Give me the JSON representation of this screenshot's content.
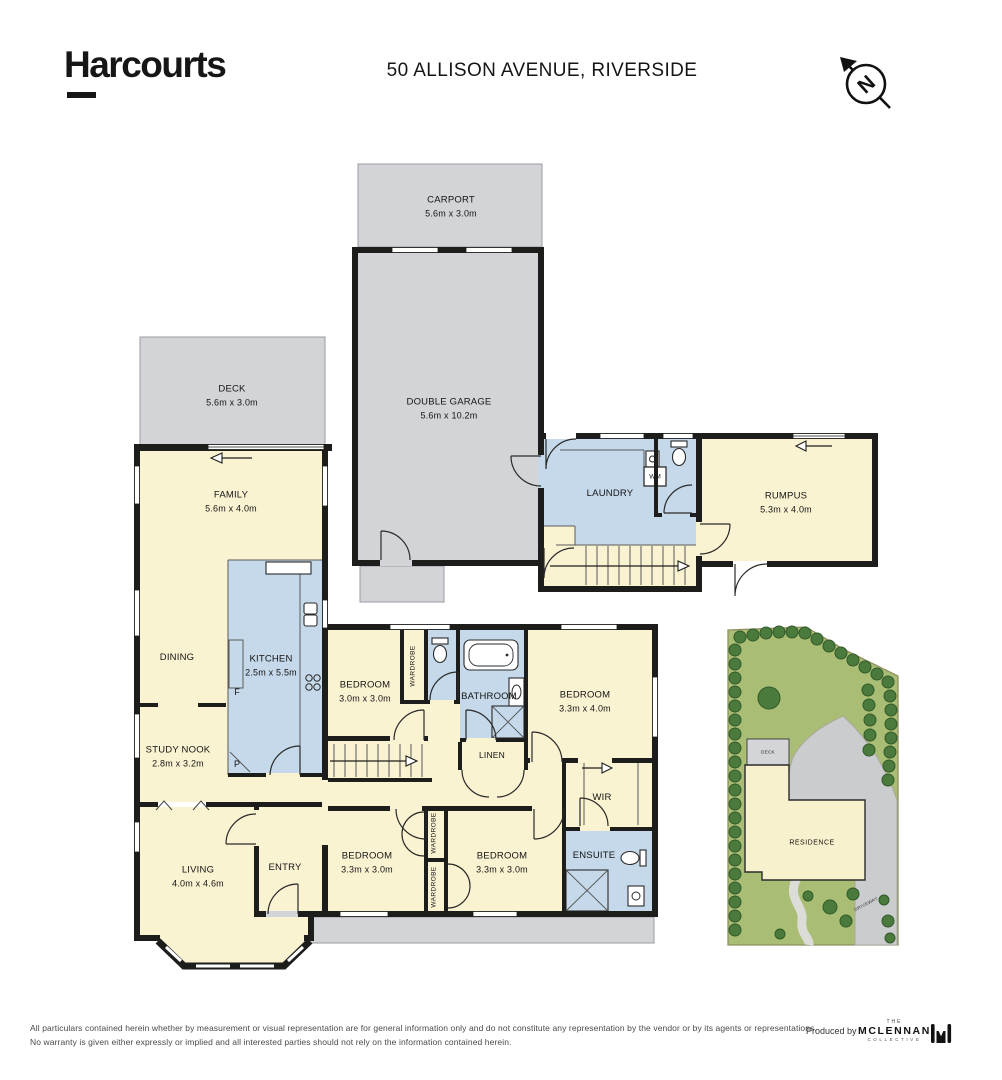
{
  "header": {
    "brand": "Harcourts",
    "address": "50 ALLISON AVENUE, RIVERSIDE",
    "compass_letter": "N"
  },
  "floorplan": {
    "rooms": {
      "carport": {
        "name": "CARPORT",
        "dims": "5.6m x 3.0m"
      },
      "double_garage": {
        "name": "DOUBLE GARAGE",
        "dims": "5.6m x 10.2m"
      },
      "deck": {
        "name": "DECK",
        "dims": "5.6m x 3.0m"
      },
      "family": {
        "name": "FAMILY",
        "dims": "5.6m x 4.0m"
      },
      "laundry": {
        "name": "LAUNDRY"
      },
      "wm": {
        "name": "WM"
      },
      "rumpus": {
        "name": "RUMPUS",
        "dims": "5.3m x 4.0m"
      },
      "dining": {
        "name": "DINING"
      },
      "kitchen": {
        "name": "KITCHEN",
        "dims": "2.5m x 5.5m"
      },
      "fridge": {
        "name": "F"
      },
      "pantry": {
        "name": "P"
      },
      "study_nook": {
        "name": "STUDY NOOK",
        "dims": "2.8m x 3.2m"
      },
      "bedroom_1": {
        "name": "BEDROOM",
        "dims": "3.0m x 3.0m"
      },
      "wardrobe_1": {
        "name": "WARDROBE"
      },
      "bathroom": {
        "name": "BATHROOM"
      },
      "bedroom_2": {
        "name": "BEDROOM",
        "dims": "3.3m x 4.0m"
      },
      "linen": {
        "name": "LINEN"
      },
      "wir": {
        "name": "WIR"
      },
      "living": {
        "name": "LIVING",
        "dims": "4.0m x 4.6m"
      },
      "entry": {
        "name": "ENTRY"
      },
      "bedroom_3": {
        "name": "BEDROOM",
        "dims": "3.3m x 3.0m"
      },
      "wardrobe_2": {
        "name": "WARDROBE"
      },
      "wardrobe_3": {
        "name": "WARDROBE"
      },
      "bedroom_4": {
        "name": "BEDROOM",
        "dims": "3.3m x 3.0m"
      },
      "ensuite": {
        "name": "ENSUITE"
      }
    },
    "colors": {
      "wall": "#1d1d1b",
      "interior": "#faf3d2",
      "wet_area": "#c5d9ea",
      "outdoor": "#d3d4d8"
    }
  },
  "siteplan": {
    "deck_label": "DECK",
    "residence_label": "RESIDENCE",
    "driveway_label": "DRIVEWAY",
    "colors": {
      "lawn": "#a9be74",
      "tree": "#4a7b3c",
      "paving": "#caccce"
    }
  },
  "footer": {
    "disclaimer_line1": "All particulars contained herein whether by measurement or visual representation are for general information only and do not constitute any representation by the vendor or by its agents or representations.",
    "disclaimer_line2": "No warranty is given either expressly or implied and all interested parties should not rely on the information contained herein.",
    "produced_by": "Produced by",
    "logo": {
      "top": "THE",
      "main": "MCLENNAN",
      "sub": "COLLECTIVE"
    }
  }
}
